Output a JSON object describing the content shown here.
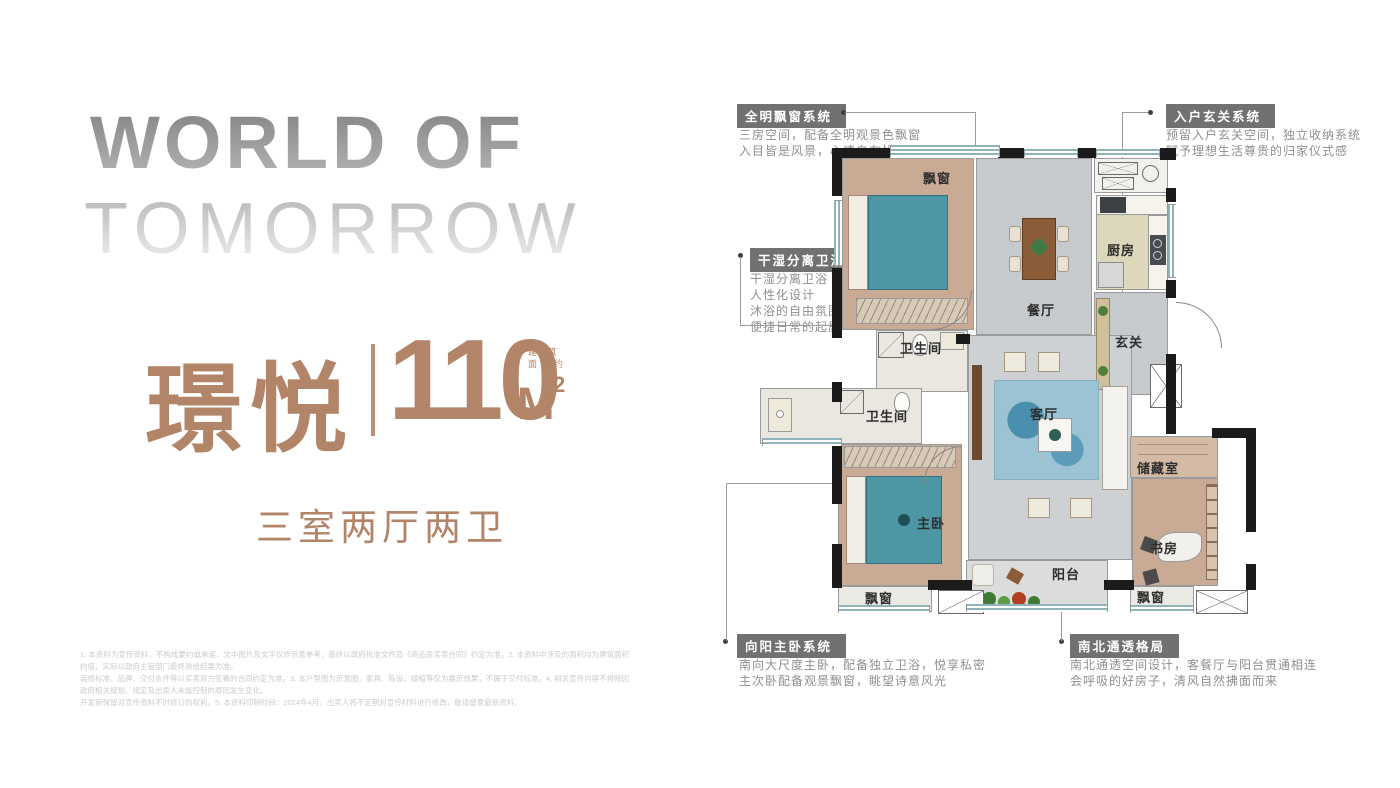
{
  "colors": {
    "accent": "#b28468",
    "callout_header_bg": "#717171",
    "callout_text": "#8f8f8f",
    "wall": "#1b1b1b",
    "bed_teal": "#4d97a5",
    "window_teal": "#8fb3ba"
  },
  "hero": {
    "line1": "WORLD OF",
    "line2": "TOMORROW",
    "name": "璟悦",
    "area_value": "110",
    "area_unit": "M",
    "area_sup": "2",
    "area_note1": "建 筑",
    "area_note2": "面积约",
    "layout": "三室两厅两卫"
  },
  "callouts": [
    {
      "title": "全明飘窗系统",
      "lines": [
        "三房空间，配备全明观景色飘窗",
        "入目皆是风景，心情自在怡然"
      ]
    },
    {
      "title": "入户玄关系统",
      "lines": [
        "预留入户玄关空间，独立收纳系统",
        "赋予理想生活尊贵的归家仪式感"
      ]
    },
    {
      "title": "干湿分离卫浴系统",
      "lines": [
        "干湿分离卫浴",
        "人性化设计",
        "沐浴的自由氛围",
        "便捷日常的起居"
      ]
    },
    {
      "title": "向阳主卧系统",
      "lines": [
        "南向大尺度主卧，配备独立卫浴，悦享私密",
        "主次卧配备观景飘窗，眺望诗意风光"
      ]
    },
    {
      "title": "南北通透格局",
      "lines": [
        "南北通透空间设计，客餐厅与阳台贯通相连",
        "会呼吸的好房子，清风自然拂面而来"
      ]
    }
  ],
  "floorplan": {
    "labels": [
      {
        "id": "bay-window-top",
        "text": "飘窗"
      },
      {
        "id": "dining",
        "text": "餐厅"
      },
      {
        "id": "kitchen",
        "text": "厨房"
      },
      {
        "id": "foyer",
        "text": "玄关"
      },
      {
        "id": "bath-top",
        "text": "卫生间"
      },
      {
        "id": "living",
        "text": "客厅"
      },
      {
        "id": "bath-left",
        "text": "卫生间"
      },
      {
        "id": "master-bedroom",
        "text": "主卧"
      },
      {
        "id": "storage",
        "text": "储藏室"
      },
      {
        "id": "study",
        "text": "书房"
      },
      {
        "id": "balcony",
        "text": "阳台"
      },
      {
        "id": "bay-window-bottom-left",
        "text": "飘窗"
      },
      {
        "id": "bay-window-bottom-right",
        "text": "飘窗"
      }
    ]
  },
  "disclaimer": {
    "line1": "1. 本资料为宣传资料，不构成要约或承诺，文中图片及文字仅作示意参考，最终以政府批准文件及《商品房买卖合同》约定为准。2. 本资料中涉及的面积均为建筑面积约值，实际以政府主管部门最终测绘结果为准。",
    "line2": "装修标准、品牌、交付条件等以买卖双方签署的合同约定为准。3. 本户型图为示意图，家具、陈设、绿植等仅为展示效果，不属于交付标准。4. 相关宣传内容不排除因政府相关规划、规定及出卖人未能控制的原因发生变化。",
    "line3": "开发商保留对宣传资料不时修订的权利。5. 本资料印制时间：2024年4月，出卖人将不定期对宣传材料进行修改，敬请留意最新资料。"
  }
}
